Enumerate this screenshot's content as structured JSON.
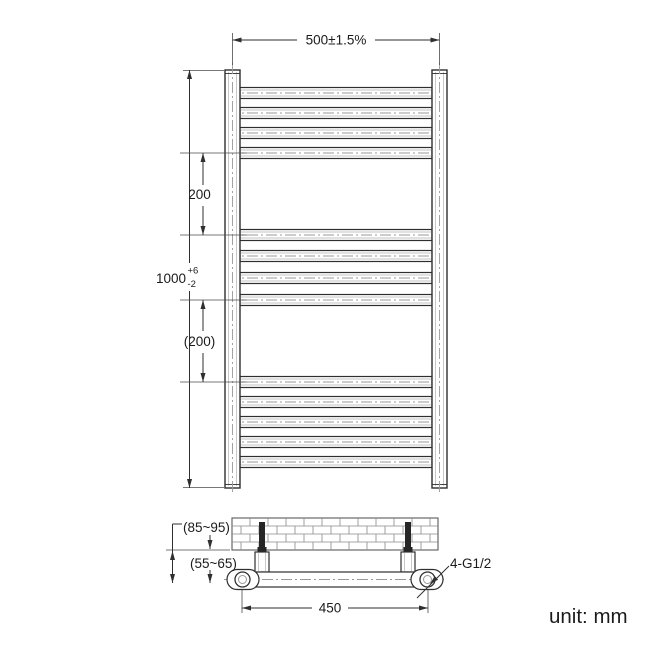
{
  "dimensions": {
    "overall_width": "500±1.5%",
    "overall_height": "1000",
    "height_tol_upper": "+6",
    "height_tol_lower": "-2",
    "rung_gap_upper": "200",
    "rung_gap_lower": "(200)",
    "wall_to_rail_outer": "(85~95)",
    "wall_to_rail_inner": "(55~65)",
    "connection_centres": "450",
    "connection_thread": "4-G1/2"
  },
  "note": {
    "unit": "unit: mm"
  },
  "front_view": {
    "bar_groups": [
      4,
      4,
      5
    ],
    "bar_centers": [
      93,
      113,
      133,
      153,
      235,
      256,
      278,
      300,
      382,
      402,
      422,
      442,
      462
    ]
  },
  "side_view": {
    "bracket_centers": [
      262,
      408
    ],
    "brick_rows": 4
  },
  "colors": {
    "line": "#2f2f2f",
    "secondary": "#c3c3c3",
    "centerline": "#9a9a9a",
    "wall": "#8a8a8a",
    "text": "#1b1b1b",
    "background": "#ffffff"
  }
}
